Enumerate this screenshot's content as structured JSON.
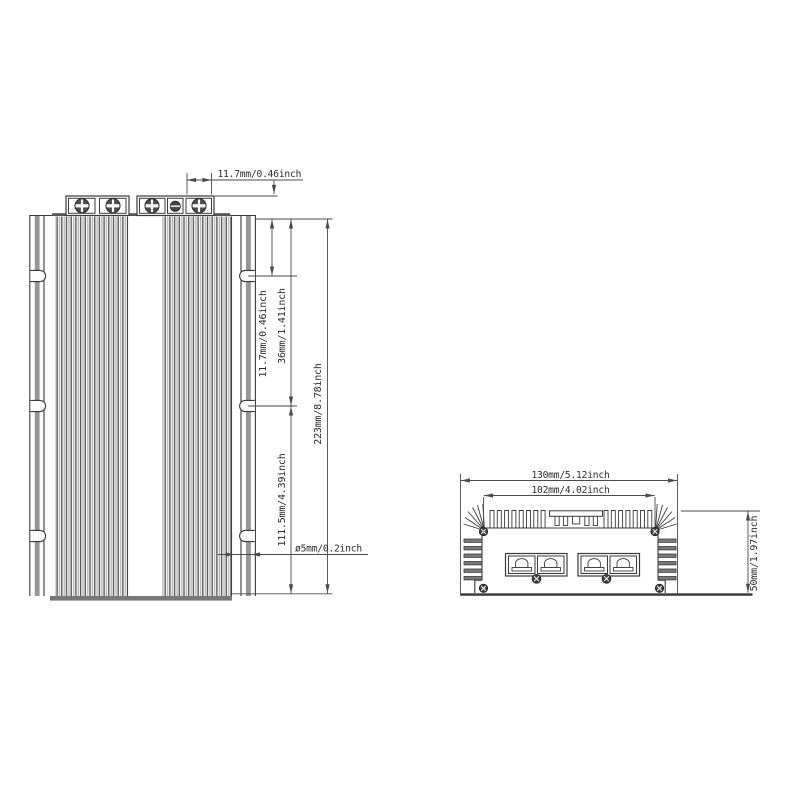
{
  "drawing": {
    "front_view": {
      "dimensions": {
        "terminal_pitch": "11.7mm/0.46inch",
        "terminal_height": "11.7mm/0.46inch",
        "top_to_first_slot": "36mm/1.41inch",
        "second_slot_to_bottom": "111.5mm/4.39inch",
        "overall_height": "223mm/8.78inch",
        "slot_diameter": "ø5mm/0.2inch"
      }
    },
    "bottom_view": {
      "dimensions": {
        "overall_width": "130mm/5.12inch",
        "mounting_width": "102mm/4.02inch",
        "overall_depth": "50mm/1.97inch"
      }
    },
    "colors": {
      "line": "#3a3a3a",
      "text": "#2b2b2b",
      "wall_gray": "#969696",
      "base_gray": "#787878",
      "background": "#ffffff"
    }
  }
}
